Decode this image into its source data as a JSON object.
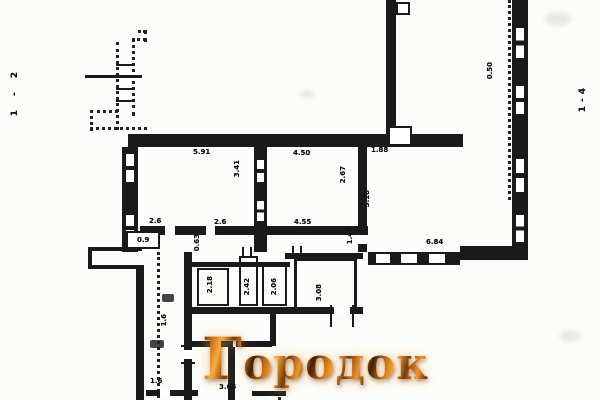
{
  "watermark": {
    "text": "Городок"
  },
  "margins": {
    "left_mark": "1-2",
    "right_mark": "1-4"
  },
  "dims": {
    "room1_width": "5.91",
    "room1_depth": "3.41",
    "room2_width": "4.50",
    "room2_depth": "2.67",
    "gap_188": "1.88",
    "room3_depth": "5.18",
    "room3_width": "6.84",
    "wall_050": "0.50",
    "corridor_26a": "2.6",
    "corridor_26b": "2.6",
    "corridor_455": "4.55",
    "opening_147": "1.47",
    "passage_063": "0.63",
    "opening_09": "0.9",
    "small_room_a": "2.18",
    "small_room_b": "2.42",
    "small_room_c": "2.06",
    "small_room_d": "3.08",
    "strip_16a": "1.6",
    "strip_16b": "1.6",
    "bottom_365": "3.65"
  }
}
